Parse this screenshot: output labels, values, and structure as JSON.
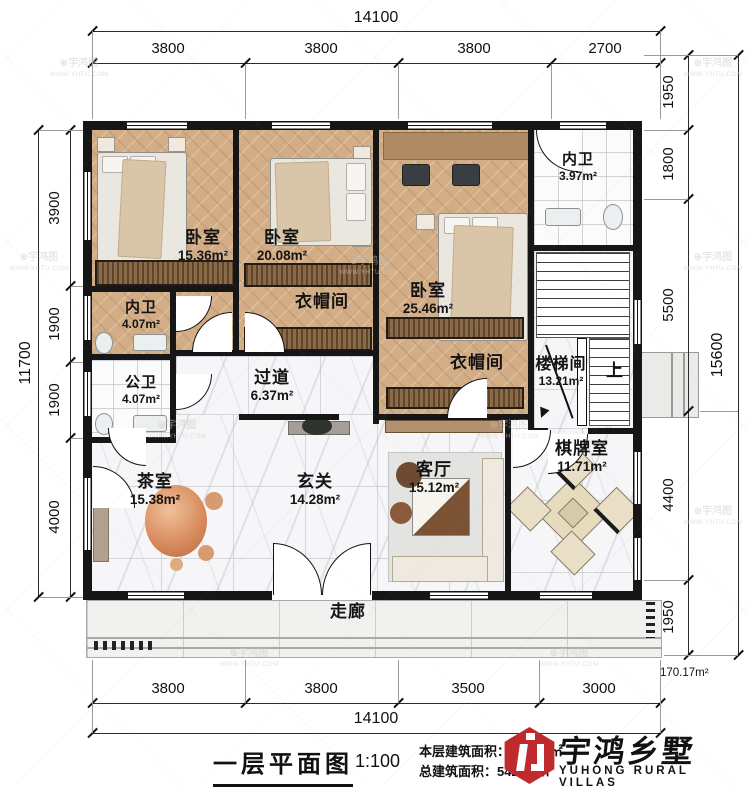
{
  "watermark": {
    "brand": "宇鸿图",
    "url": "WWW.YHTU.COM"
  },
  "dims": {
    "top_total": "14100",
    "top_segments": [
      "3800",
      "3800",
      "3800",
      "2700"
    ],
    "bottom_total": "14100",
    "bottom_segments": [
      "3800",
      "3800",
      "3500",
      "3000"
    ],
    "left_total": "11700",
    "left_segments": [
      "3900",
      "1900",
      "1900",
      "4000"
    ],
    "right_total": "15600",
    "right_segments": [
      "1950",
      "1800",
      "5500",
      "4400",
      "1950"
    ],
    "area_note": "170.17m²"
  },
  "rooms": {
    "bedroom1": {
      "name": "卧室",
      "area": "15.36m²"
    },
    "bedroom2": {
      "name": "卧室",
      "area": "20.08m²"
    },
    "bedroom3": {
      "name": "卧室",
      "area": "25.46m²"
    },
    "ensuite_top": {
      "name": "内卫",
      "area": "3.97m²"
    },
    "ensuite_left": {
      "name": "内卫",
      "area": "4.07m²"
    },
    "public_bath": {
      "name": "公卫",
      "area": "4.07m²"
    },
    "passage": {
      "name": "过道",
      "area": "6.37m²"
    },
    "closet1": {
      "name": "衣帽间"
    },
    "closet2": {
      "name": "衣帽间"
    },
    "stairwell": {
      "name": "楼梯间",
      "area": "13.21m²",
      "up": "上"
    },
    "chess_room": {
      "name": "棋牌室",
      "area": "11.71m²"
    },
    "tea_room": {
      "name": "茶室",
      "area": "15.38m²"
    },
    "foyer": {
      "name": "玄关",
      "area": "14.28m²"
    },
    "living_room": {
      "name": "客厅",
      "area": "15.12m²"
    },
    "corridor": {
      "name": "走廊"
    }
  },
  "title_block": {
    "title": "一层平面图",
    "scale": "1:100",
    "floor_area_label": "本层建筑面积：",
    "floor_area_value": "180.90㎡",
    "total_area_label": "总建筑面积：",
    "total_area_value": "542.07㎡",
    "brand_cn": "宇鸿乡墅",
    "brand_en": "YUHONG RURAL VILLAS"
  }
}
